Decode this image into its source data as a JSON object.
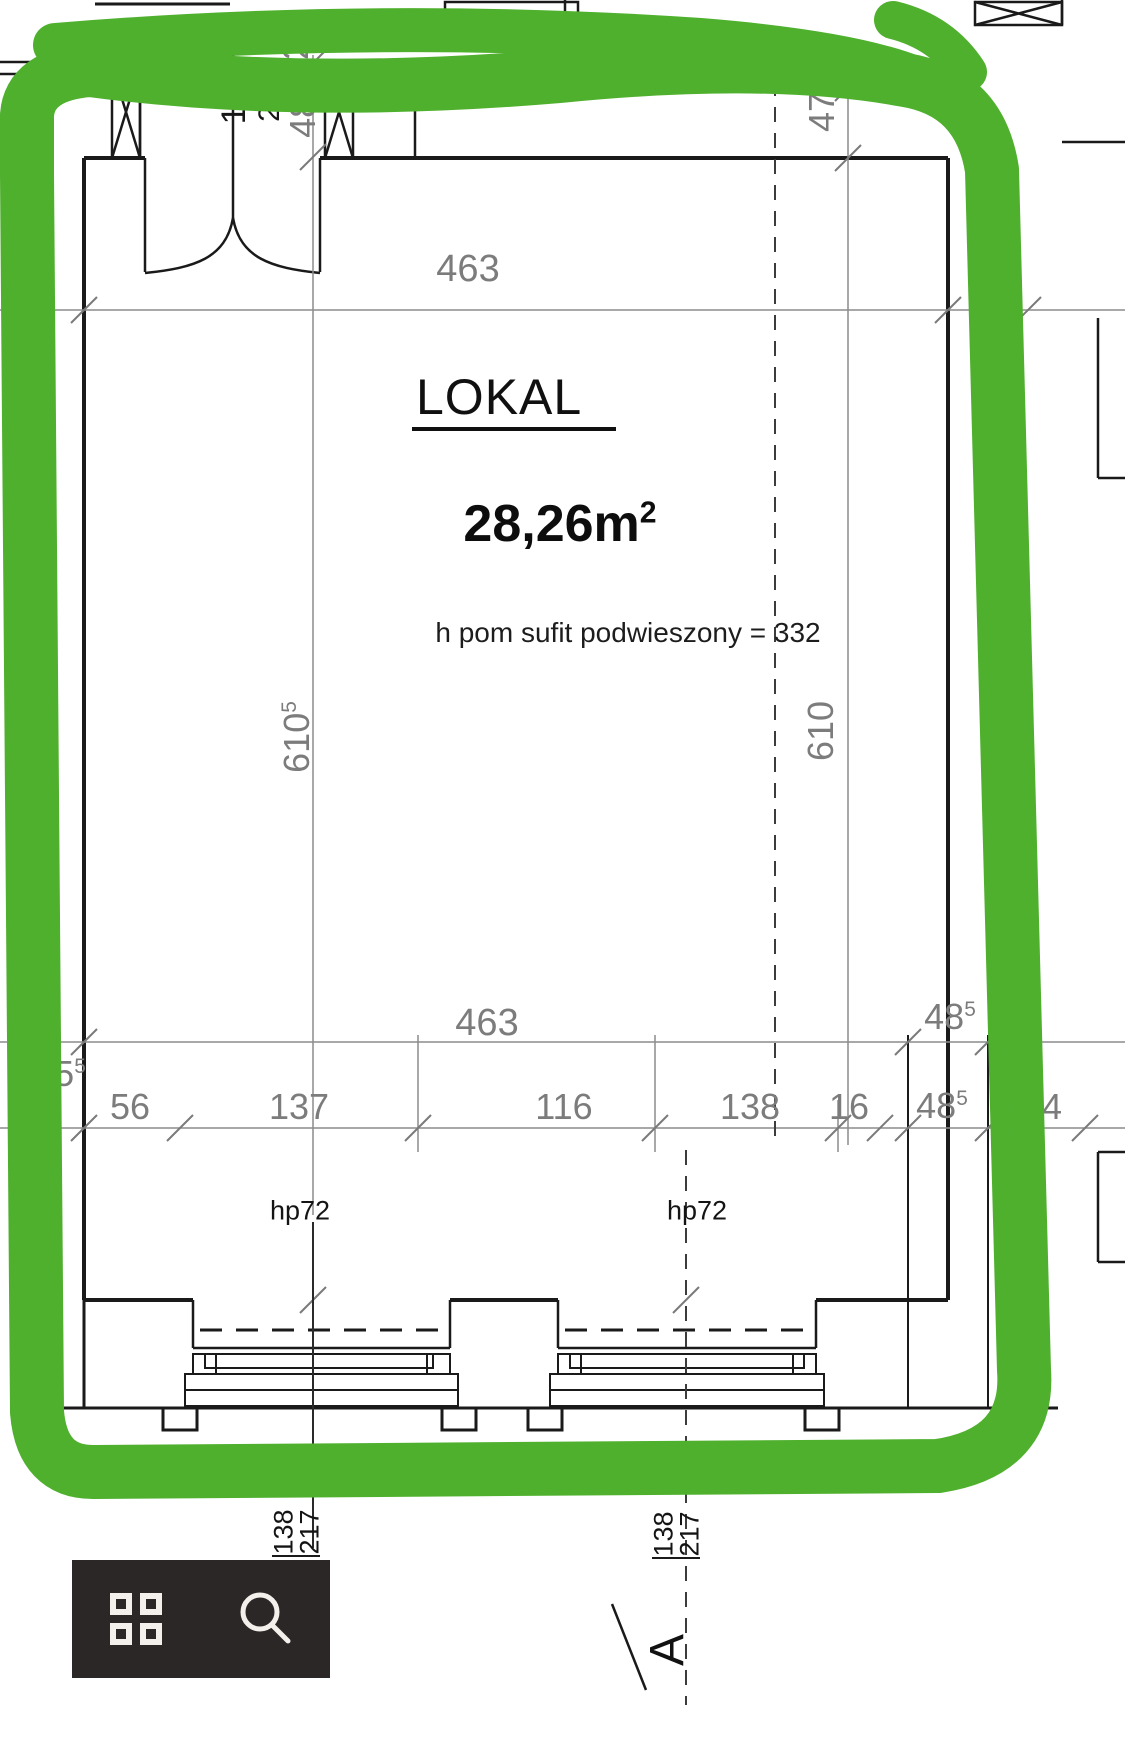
{
  "plan": {
    "title": "LOKAL",
    "area_value": "28,26m",
    "area_sup": "2",
    "ceiling_note": "h pom sufit podwieszony = 332",
    "labels": {
      "hp_left": "hp72",
      "hp_right": "hp72",
      "section_letter": "A"
    },
    "axes": {
      "left_num": "138",
      "left_den": "217",
      "right_num": "138",
      "right_den": "217"
    },
    "dims": {
      "door_width": "122",
      "door_extra": "2...",
      "door_wall": "48",
      "door_wall_sup": "5",
      "door_top": "2",
      "top_offset": "47",
      "top_width": "463",
      "top_right_wall": "48",
      "height_left": "610",
      "height_left_sup": "5",
      "height_right": "610",
      "mid_width": "463",
      "mid_right_wall": "48",
      "mid_right_wall_sup": "5",
      "left_outer": "25",
      "left_outer_sup": "5",
      "seg1": "56",
      "seg2": "137",
      "seg3": "116",
      "seg4": "138",
      "seg5": "16",
      "wall_thickness": "48",
      "wall_thickness_sup": "5",
      "edge_partial": "4"
    }
  },
  "annotation": {
    "marker_color": "#4fb02e",
    "shape": "freehand-rectangle-loop"
  },
  "toolbar": {
    "background": "#2b2727",
    "icons": [
      "grid-icon",
      "search-icon"
    ]
  },
  "colors": {
    "line_black": "#1a1a1a",
    "dim_gray": "#8c8c8c",
    "text_gray": "#7c7c7c"
  }
}
